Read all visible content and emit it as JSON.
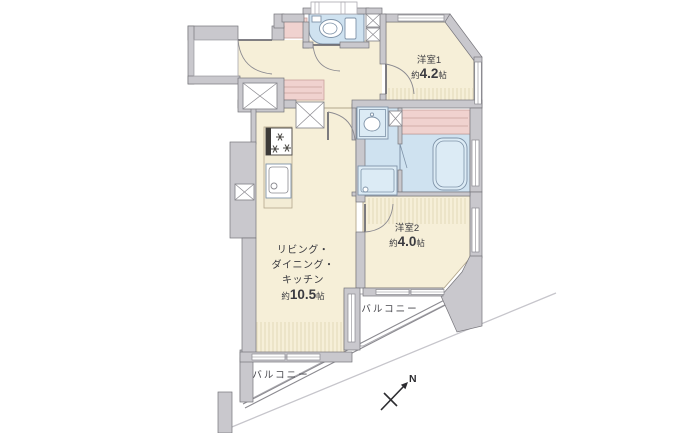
{
  "rooms": {
    "western1": {
      "name": "洋室1",
      "about": "約",
      "area": "4.2",
      "unit": "帖"
    },
    "western2": {
      "name": "洋室2",
      "about": "約",
      "area": "4.0",
      "unit": "帖"
    },
    "ldk": {
      "line1": "リビング・",
      "line2": "ダイニング・",
      "line3": "キッチン",
      "about": "約",
      "area": "10.5",
      "unit": "帖"
    }
  },
  "balconies": {
    "left": "バルコニー",
    "right": "バルコニー"
  },
  "compass": {
    "north": "N"
  },
  "colors": {
    "bg": "#ffffff",
    "floor": "#f6efd8",
    "wet": "#cfe2f0",
    "closet": "#f0d2cf",
    "wall": "#c9c8cd",
    "wall_line": "#76757b",
    "outline": "#8b8a90",
    "text": "#3b3b40",
    "hatch": "#e6dcbe",
    "fixture": "#dcebf5",
    "fixture_line": "#7f93a8"
  }
}
